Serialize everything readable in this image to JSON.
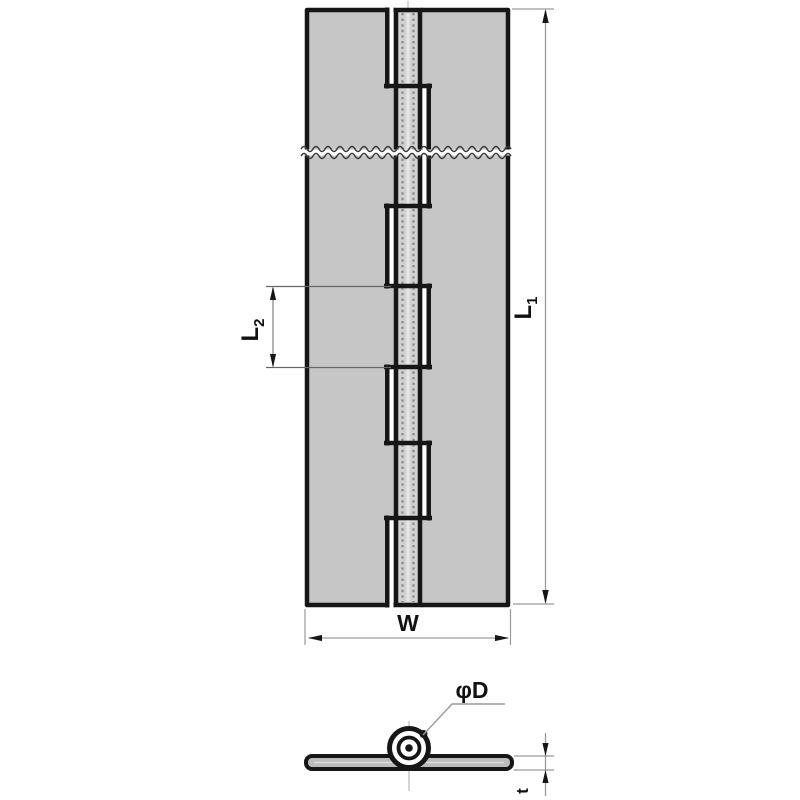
{
  "labels": {
    "overall_length": {
      "main": "L",
      "sub": "1"
    },
    "knuckle_length": {
      "main": "L",
      "sub": "2"
    },
    "width": "W",
    "pin_diameter": "φD",
    "thickness": "t"
  },
  "colors": {
    "leaf_fill": "#c6c6c6",
    "column_fill": "#d1d1d1",
    "outline": "#161616",
    "dim_line": "#9a9a9a",
    "ext_line_dark": "#666666",
    "pin_hidden_line": "#8a8a8a",
    "pin_center_stripe": "#e6e6e6",
    "label_color": "#111111",
    "background": "#ffffff"
  },
  "knuckle": {
    "segments": [
      {
        "y0": 10,
        "y1": 86,
        "owner": "right"
      },
      {
        "y0": 86,
        "y1": 150,
        "owner": "left"
      },
      {
        "y0": 155,
        "y1": 206,
        "owner": "left"
      },
      {
        "y0": 206,
        "y1": 286,
        "owner": "right"
      },
      {
        "y0": 286,
        "y1": 367,
        "owner": "left"
      },
      {
        "y0": 367,
        "y1": 443,
        "owner": "right"
      },
      {
        "y0": 443,
        "y1": 518,
        "owner": "left"
      },
      {
        "y0": 518,
        "y1": 605,
        "owner": "right"
      }
    ],
    "steps": [
      86,
      206,
      286,
      367,
      443,
      518
    ]
  }
}
